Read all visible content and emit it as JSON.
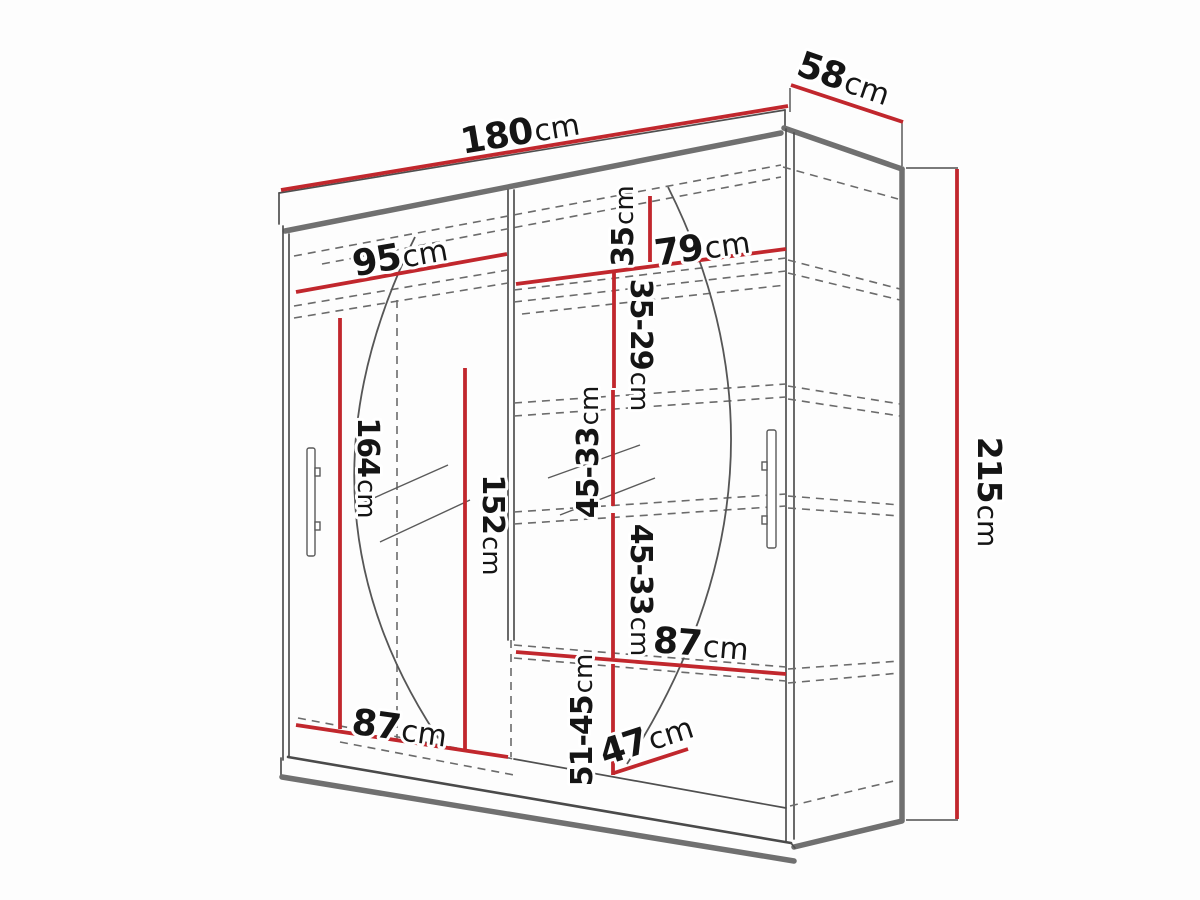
{
  "colors": {
    "dimension_red": "#c1272d",
    "outline_gray": "#4f4f4f",
    "panel_gray": "#707070"
  },
  "dimensions": {
    "width": {
      "value": "180",
      "unit": "cm"
    },
    "depth": {
      "value": "58",
      "unit": "cm"
    },
    "height": {
      "value": "215",
      "unit": "cm"
    },
    "left_section_top_width": {
      "value": "95",
      "unit": "cm"
    },
    "right_section_top_width": {
      "value": "79",
      "unit": "cm"
    },
    "top_shelf_gap": {
      "value": "35",
      "unit": "cm"
    },
    "shelf_gap_1": {
      "value": "35-29",
      "unit": "cm"
    },
    "shelf_gap_2": {
      "value": "45-33",
      "unit": "cm"
    },
    "shelf_gap_3": {
      "value": "45-33",
      "unit": "cm"
    },
    "hanging_space_height": {
      "value": "164",
      "unit": "cm"
    },
    "mirror_door_height": {
      "value": "152",
      "unit": "cm"
    },
    "right_section_shelf_width": {
      "value": "87",
      "unit": "cm"
    },
    "left_section_bottom_width": {
      "value": "87",
      "unit": "cm"
    },
    "bottom_shelf_gap": {
      "value": "51-45",
      "unit": "cm"
    },
    "bottom_shelf_depth": {
      "value": "47",
      "unit": "cm"
    }
  }
}
